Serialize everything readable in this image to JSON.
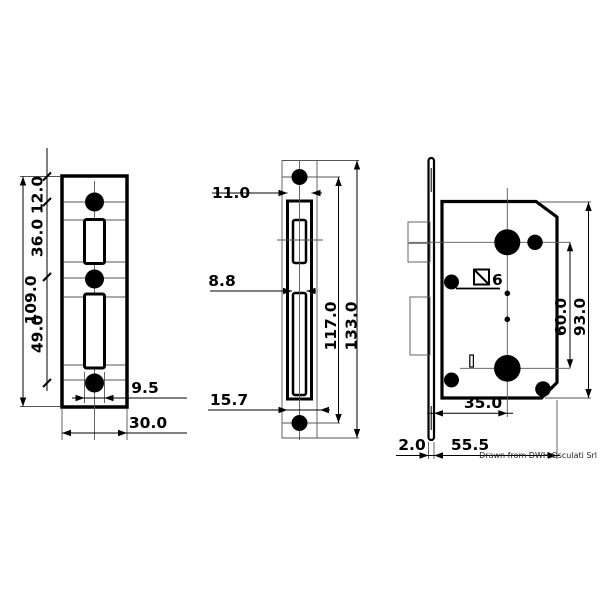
{
  "credit": "Drawn from DWH Osculati Srl",
  "views": {
    "strike_plate": {
      "dims": {
        "total_height": "109.0",
        "top_offset": "12.0",
        "upper_spacing": "36.0",
        "lower_spacing": "49.0",
        "slot_width": "9.5",
        "plate_width": "30.0"
      }
    },
    "faceplate": {
      "dims": {
        "plate_width": "11.0",
        "slot_width": "8.8",
        "bottom_offset": "15.7",
        "hole_centers": "117.0",
        "total_length": "133.0"
      }
    },
    "lock_body": {
      "spindle_size": "6",
      "dims": {
        "backset": "35.0",
        "centers_spacing": "60.0",
        "body_height": "93.0",
        "faceplate_thickness": "2.0",
        "body_depth": "55.5"
      }
    }
  }
}
